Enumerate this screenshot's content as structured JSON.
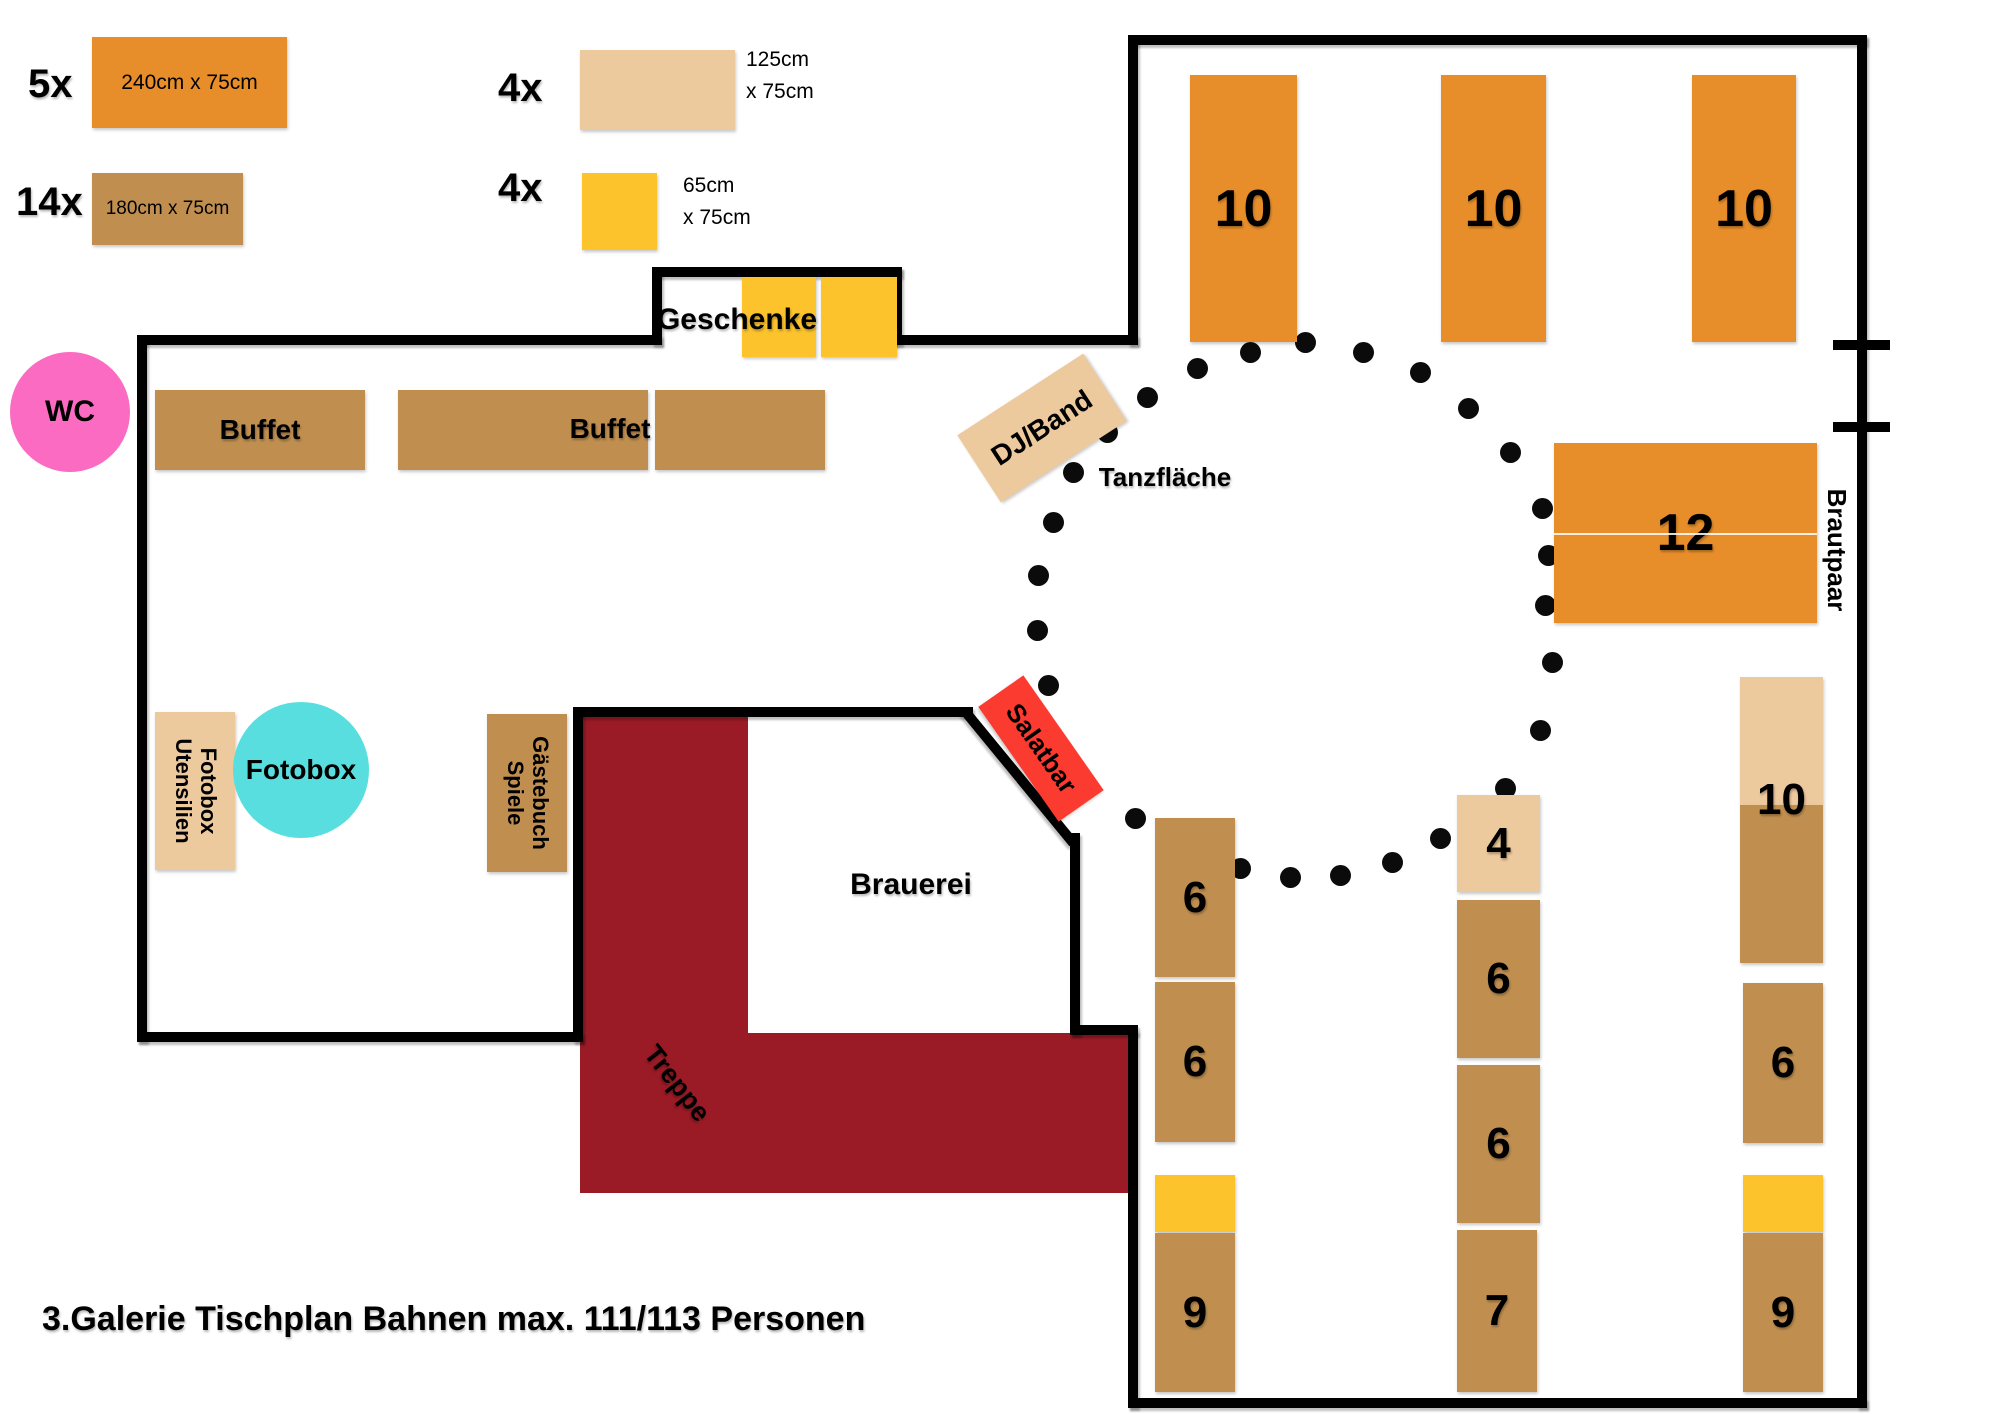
{
  "title": "3.Galerie Tischplan Bahnen max. 111/113 Personen",
  "legend": {
    "item1": {
      "count": "5x",
      "label": "240cm x 75cm"
    },
    "item2": {
      "count": "14x",
      "label": "180cm x 75cm"
    },
    "item3": {
      "count": "4x",
      "line1": "125cm",
      "line2": "x 75cm"
    },
    "item4": {
      "count": "4x",
      "line1": "65cm",
      "line2": "x 75cm"
    }
  },
  "labels": {
    "wc": "WC",
    "fotobox_circle": "Fotobox",
    "fotobox_utensilien_line1": "Fotobox",
    "fotobox_utensilien_line2": "Utensilien",
    "gaestebuch_line1": "Gästebuch",
    "gaestebuch_line2": "Spiele",
    "buffet_left": "Buffet",
    "buffet_right": "Buffet",
    "geschenke": "Geschenke",
    "dj_band": "DJ/Band",
    "salatbar": "Salatbar",
    "tanzflaeche": "Tanzfläche",
    "brautpaar": "Brautpaar",
    "brauerei": "Brauerei",
    "treppe": "Treppe",
    "right_tower_number": "10"
  },
  "colors": {
    "orange": "#E78E2B",
    "brown": "#C08F50",
    "tan": "#EDC99E",
    "yellow": "#FCC32D",
    "red": "#FB3A30",
    "maroon": "#9A1B26",
    "pink": "#FB6BC2",
    "cyan": "#58DEDE",
    "wall": "#000000"
  },
  "tables": [
    {
      "x": 1190,
      "y": 75,
      "w": 107,
      "h": 267,
      "c": "orange",
      "label": "10",
      "fs": 52
    },
    {
      "x": 1441,
      "y": 75,
      "w": 105,
      "h": 267,
      "c": "orange",
      "label": "10",
      "fs": 52
    },
    {
      "x": 1692,
      "y": 75,
      "w": 104,
      "h": 267,
      "c": "orange",
      "label": "10",
      "fs": 52
    },
    {
      "x": 1554,
      "y": 443,
      "w": 263,
      "h": 180,
      "c": "orange",
      "label": "12",
      "fs": 52,
      "divider": true
    },
    {
      "x": 155,
      "y": 390,
      "w": 210,
      "h": 80,
      "c": "brown",
      "label": "Buffet",
      "fs": 28
    },
    {
      "x": 398,
      "y": 390,
      "w": 250,
      "h": 80,
      "c": "brown"
    },
    {
      "x": 655,
      "y": 390,
      "w": 170,
      "h": 80,
      "c": "brown"
    },
    {
      "x": 742,
      "y": 277,
      "w": 74,
      "h": 80,
      "c": "yellow"
    },
    {
      "x": 821,
      "y": 277,
      "w": 76,
      "h": 80,
      "c": "yellow"
    },
    {
      "x": 155,
      "y": 712,
      "w": 80,
      "h": 158,
      "c": "tan"
    },
    {
      "x": 487,
      "y": 714,
      "w": 80,
      "h": 158,
      "c": "brown"
    },
    {
      "x": 1155,
      "y": 818,
      "w": 80,
      "h": 159,
      "c": "brown",
      "label": "6",
      "fs": 44
    },
    {
      "x": 1155,
      "y": 982,
      "w": 80,
      "h": 160,
      "c": "brown",
      "label": "6",
      "fs": 44
    },
    {
      "x": 1155,
      "y": 1175,
      "w": 80,
      "h": 57,
      "c": "yellow"
    },
    {
      "x": 1155,
      "y": 1233,
      "w": 80,
      "h": 159,
      "c": "brown",
      "label": "9",
      "fs": 44
    },
    {
      "x": 1457,
      "y": 795,
      "w": 83,
      "h": 97,
      "c": "tan",
      "label": "4",
      "fs": 44
    },
    {
      "x": 1457,
      "y": 900,
      "w": 83,
      "h": 158,
      "c": "brown",
      "label": "6",
      "fs": 44
    },
    {
      "x": 1457,
      "y": 1065,
      "w": 83,
      "h": 158,
      "c": "brown",
      "label": "6",
      "fs": 44
    },
    {
      "x": 1457,
      "y": 1230,
      "w": 80,
      "h": 162,
      "c": "brown",
      "label": "7",
      "fs": 44
    },
    {
      "x": 1740,
      "y": 677,
      "w": 83,
      "h": 128,
      "c": "tan"
    },
    {
      "x": 1740,
      "y": 805,
      "w": 83,
      "h": 158,
      "c": "brown"
    },
    {
      "x": 1743,
      "y": 983,
      "w": 80,
      "h": 160,
      "c": "brown",
      "label": "6",
      "fs": 44
    },
    {
      "x": 1743,
      "y": 1175,
      "w": 80,
      "h": 57,
      "c": "yellow"
    },
    {
      "x": 1743,
      "y": 1233,
      "w": 80,
      "h": 159,
      "c": "brown",
      "label": "9",
      "fs": 44
    }
  ],
  "dance_dots": [
    [
      1073,
      472
    ],
    [
      1053,
      522
    ],
    [
      1038,
      575
    ],
    [
      1037,
      630
    ],
    [
      1048,
      685
    ],
    [
      1135,
      818
    ],
    [
      1240,
      868
    ],
    [
      1290,
      877
    ],
    [
      1340,
      875
    ],
    [
      1392,
      862
    ],
    [
      1440,
      838
    ],
    [
      1505,
      788
    ],
    [
      1540,
      730
    ],
    [
      1552,
      662
    ],
    [
      1545,
      605
    ],
    [
      1548,
      555
    ],
    [
      1542,
      508
    ],
    [
      1510,
      452
    ],
    [
      1468,
      408
    ],
    [
      1420,
      372
    ],
    [
      1363,
      352
    ],
    [
      1305,
      342
    ],
    [
      1250,
      352
    ],
    [
      1197,
      368
    ],
    [
      1147,
      397
    ],
    [
      1107,
      432
    ]
  ]
}
